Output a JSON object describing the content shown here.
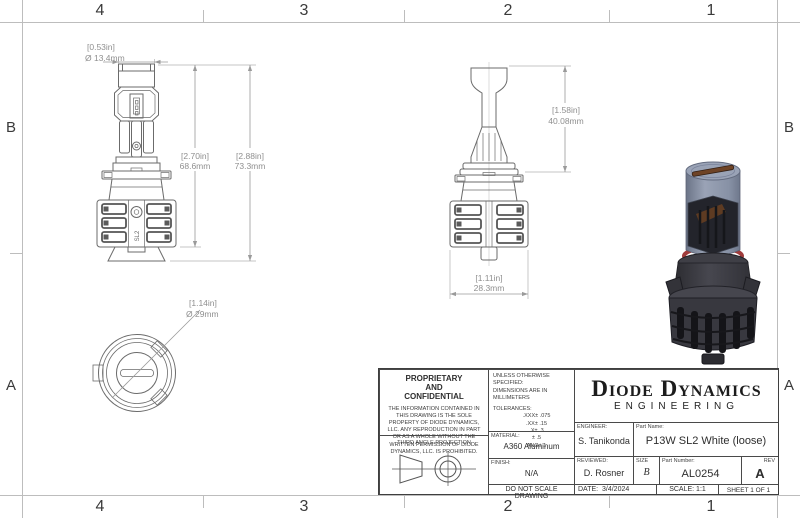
{
  "sheet": {
    "zone_numbers": [
      "4",
      "3",
      "2",
      "1"
    ],
    "zone_letters": [
      "B",
      "A"
    ]
  },
  "views": {
    "front": {
      "dim_diameter_in": "[0.53in]",
      "dim_diameter_mm": "Ø 13.4mm",
      "dim_body_in": "[2.70in]",
      "dim_body_mm": "68.6mm",
      "dim_total_in": "[2.88in]",
      "dim_total_mm": "73.3mm",
      "logo": "SL2"
    },
    "side": {
      "dim_top_in": "[1.58in]",
      "dim_top_mm": "40.08mm",
      "dim_width_in": "[1.11in]",
      "dim_width_mm": "28.3mm"
    },
    "bottom": {
      "dim_diameter_in": "[1.14in]",
      "dim_diameter_mm": "Ø 29mm"
    }
  },
  "title_block": {
    "proprietary_heading": [
      "PROPRIETARY",
      "AND",
      "CONFIDENTIAL"
    ],
    "proprietary_body": "THE INFORMATION CONTAINED IN THIS DRAWING IS THE SOLE PROPERTY OF DIODE DYNAMICS, LLC.  ANY REPRODUCTION IN PART OR AS A WHOLE WITHOUT THE WRITTEN PERMISSION OF DIODE DYNAMICS, LLC. IS PROHIBITED.",
    "third_angle_label": "THIRD ANGLE PROJECTION",
    "unless": "UNLESS OTHERWISE SPECIFIED:",
    "dims_units": "DIMENSIONS ARE IN MILLIMETERS",
    "tolerances_heading": "TOLERANCES:",
    "tolerances": [
      ".XXX± .075",
      ".XX± .15",
      ".X± .3",
      "± .5",
      "ANG± 1"
    ],
    "material_label": "MATERIAL:",
    "material_value": "A360 Aluminum",
    "finish_label": "FINISH:",
    "finish_value": "N/A",
    "do_not_scale": "DO NOT SCALE DRAWING",
    "company_name": "Diode Dynamics",
    "company_division": "ENGINEERING",
    "engineer_label": "ENGINEER:",
    "engineer_value": "S. Tanikonda",
    "reviewed_label": "REVIEWED:",
    "reviewed_value": "D. Rosner",
    "part_name_label": "Part Name:",
    "part_name_value": "P13W SL2 White (loose)",
    "size_label": "SIZE",
    "size_value": "B",
    "part_number_label": "Part Number:",
    "part_number_value": "AL0254",
    "rev_label": "REV",
    "rev_value": "A",
    "date_label": "DATE:",
    "date_value": "3/4/2024",
    "scale_text": "SCALE: 1:1",
    "sheet_text": "SHEET 1 OF 1"
  },
  "colors": {
    "line": "#6b6b6b",
    "dim": "#9a9a9a",
    "frame": "#bdbdbd",
    "render_top_metal": "#96a0b4",
    "render_body": "#3a3a40",
    "render_oring": "#a03c3c",
    "render_copper": "#6e4326"
  }
}
